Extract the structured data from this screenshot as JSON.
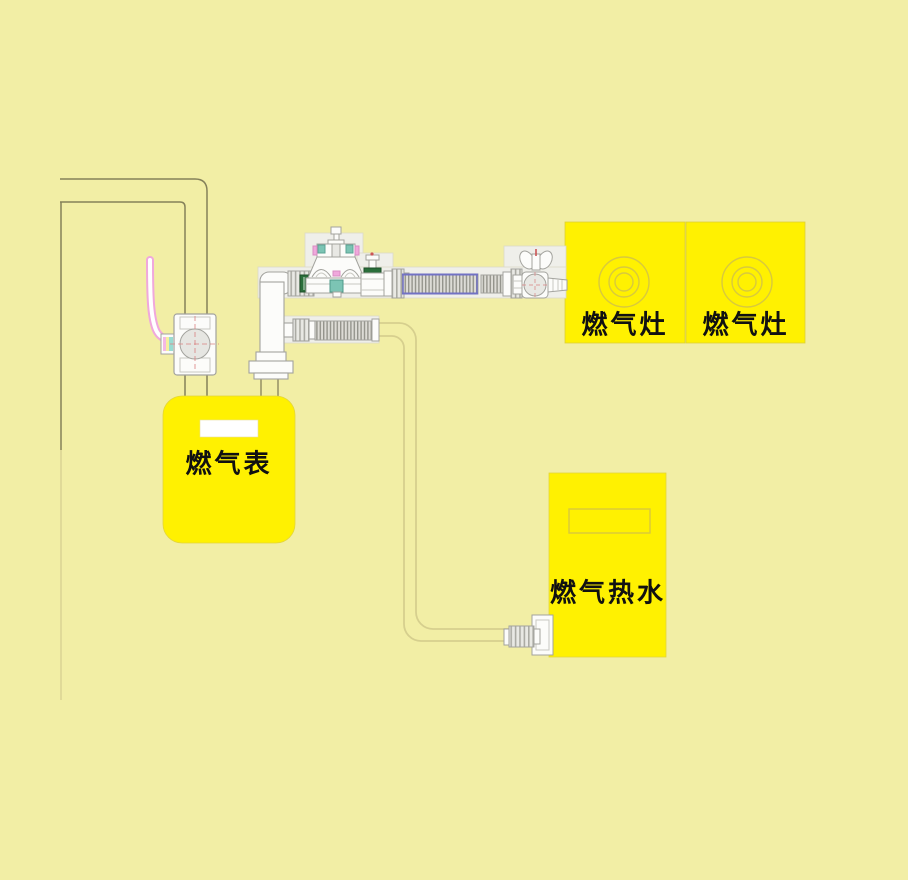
{
  "figure": {
    "type": "gas-piping-installation-diagram",
    "labels": {
      "meter": "燃气表",
      "stove_left": "燃气灶",
      "stove_right": "燃气灶",
      "water_heater": "燃气热水"
    },
    "colors": {
      "background": "#f2eea5",
      "appliance_yellow": "#fff101",
      "burner_ring": "#d8c93d",
      "pipe_line_olive": "#85815a",
      "drawing_gray": "#a3a39e",
      "drawing_white": "#fcfcfa",
      "plate_white": "#efefea",
      "accent_pink": "#f0a8dc",
      "accent_blue": "#7272c4",
      "accent_teal": "#7cc4b4",
      "accent_dark_green": "#2a6e3a",
      "accent_red": "#cc5555",
      "tube_tan": "#d6cf8e",
      "meter_window_white": "#ffffff"
    },
    "components": [
      {
        "name": "wall-corner-lines"
      },
      {
        "name": "gas-inlet-pipe"
      },
      {
        "name": "meter-shutoff-valve"
      },
      {
        "name": "valve-lever-icon"
      },
      {
        "name": "gas-meter-box"
      },
      {
        "name": "meter-outlet-elbow"
      },
      {
        "name": "pipe-union-green-seal"
      },
      {
        "name": "pressure-regulator"
      },
      {
        "name": "stop-valve"
      },
      {
        "name": "corrugated-hose-blue-stripe"
      },
      {
        "name": "corrugated-hose-short"
      },
      {
        "name": "stove-ball-valve-wing-handle"
      },
      {
        "name": "hose-nozzle"
      },
      {
        "name": "gas-stove-box-left"
      },
      {
        "name": "gas-stove-box-right"
      },
      {
        "name": "burner-rings-icon"
      },
      {
        "name": "lower-corrugated-hose"
      },
      {
        "name": "water-heater-supply-tube"
      },
      {
        "name": "water-heater-connector"
      },
      {
        "name": "water-heater-box"
      }
    ]
  }
}
